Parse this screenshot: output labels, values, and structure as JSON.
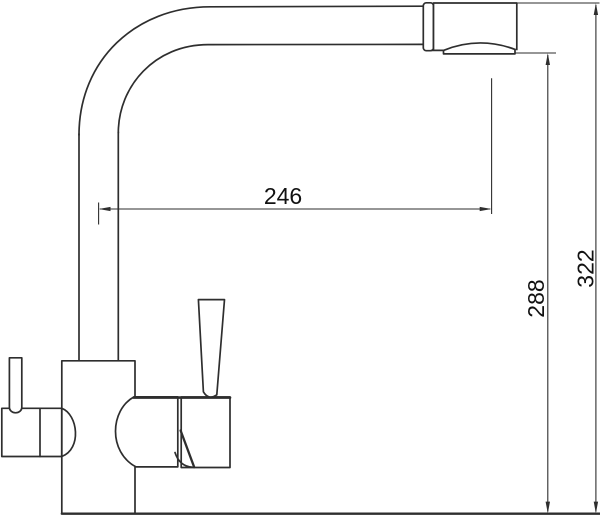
{
  "diagram": {
    "dimensions": {
      "spout_reach": {
        "value": "246",
        "orientation": "horizontal"
      },
      "outlet_height": {
        "value": "288",
        "orientation": "vertical"
      },
      "overall_height": {
        "value": "322",
        "orientation": "vertical"
      }
    },
    "colors": {
      "line": "#2e2e2e",
      "text": "#111111",
      "background": "#ffffff"
    }
  }
}
